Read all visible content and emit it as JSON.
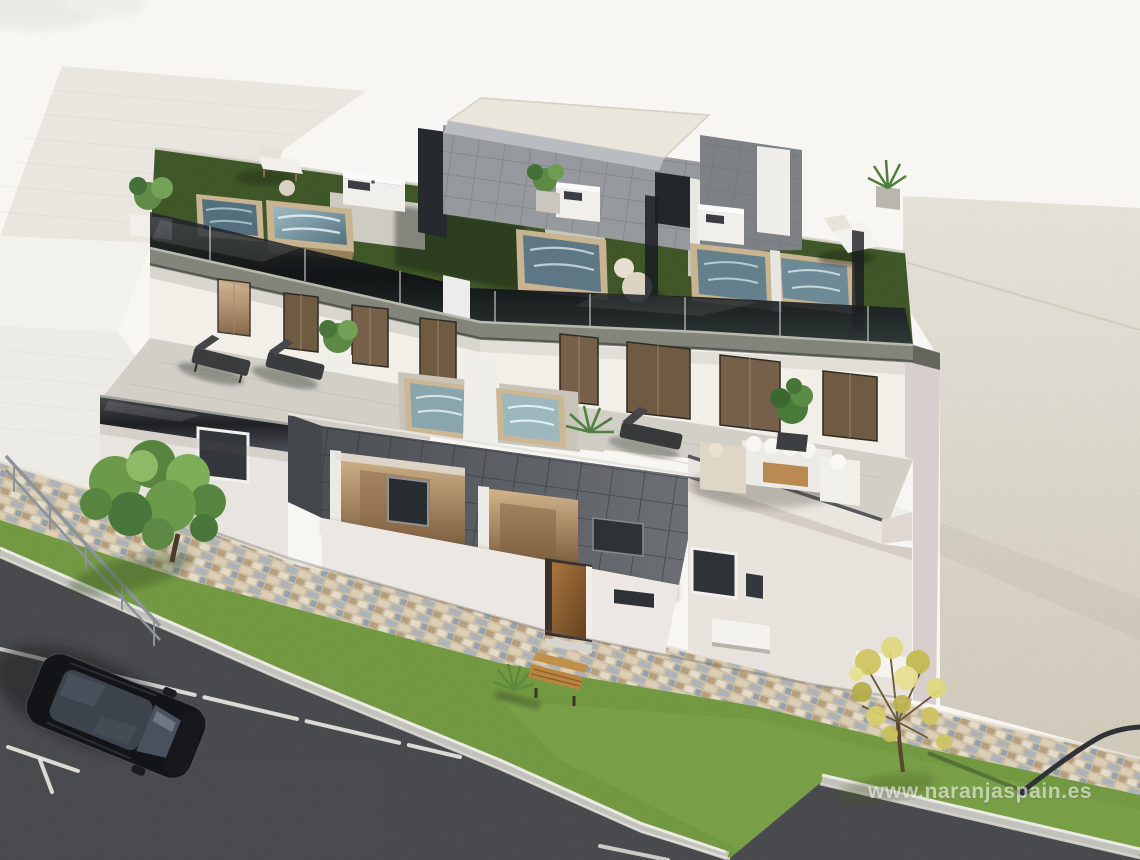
{
  "watermark": {
    "text": "www.naranjaspain.es",
    "color_hex": "#ffffff",
    "opacity": 0.58
  },
  "scene": {
    "kind": "architectural-render",
    "view": "aerial-oblique",
    "description": "New-build modern two-storey residential duplex with rooftop terraces, artificial grass, plunge pools, glass balustrades, anthracite tile cladding, street with parked black SUV, cobblestone sidewalk, lawns and trees, empty plot at right",
    "objects": [
      {
        "label": "neighbouring white building"
      },
      {
        "label": "main duplex building"
      },
      {
        "label": "rooftop terraces with artificial grass"
      },
      {
        "label": "rooftop plunge pools with wooden rims"
      },
      {
        "label": "rooftop outdoor kitchens"
      },
      {
        "label": "penthouse stair-access box"
      },
      {
        "label": "dark glass balustrades"
      },
      {
        "label": "first-floor terrace with plunge pools"
      },
      {
        "label": "outdoor sofa set and coffee table"
      },
      {
        "label": "sun loungers"
      },
      {
        "label": "round poufs"
      },
      {
        "label": "potted plants"
      },
      {
        "label": "bronze glazed terrace doors"
      },
      {
        "label": "anthracite tiled facade volume"
      },
      {
        "label": "wooden entrance door"
      },
      {
        "label": "cobblestone sidewalk"
      },
      {
        "label": "lawn strip"
      },
      {
        "label": "green tree"
      },
      {
        "label": "yellow autumn tree"
      },
      {
        "label": "wooden bench"
      },
      {
        "label": "metal handrail"
      },
      {
        "label": "street lamp"
      },
      {
        "label": "asphalt street with white road markings"
      },
      {
        "label": "parking bay lines"
      },
      {
        "label": "black SUV parked"
      },
      {
        "label": "empty gravel plot"
      }
    ]
  },
  "colors": {
    "sky": "#f7f6f3",
    "lot_far": "#ebe8df",
    "lot_near": "#dcd6c7",
    "neighbor_roof": "#e9e6e0",
    "neighbor_band": "#f3f1ec",
    "neighbor_wall": "#edebe5",
    "wall_white": "#f2efe9",
    "wall_shaded": "#e7e1dc",
    "wall_pink": "#d9cfce",
    "fascia": "#83857a",
    "fascia_dark": "#64665c",
    "glass_dark": "#14171c",
    "tile_dark": "#5d6166",
    "tile_side": "#43464b",
    "penthouse_tile": "#96999e",
    "roof_slab": "#eae6dc",
    "grass_roof": "#46602c",
    "grass_lawn": "#7aa246",
    "pool_water_dark": "#54707e",
    "pool_water_light": "#8fb0ba",
    "pool_rim": "#c9b492",
    "terrace_floor": "#d2cfc7",
    "cobble_base": "#cbbda2",
    "asphalt": "#45474a",
    "curb_concrete": "#c3c1bb",
    "road_marking": "#eceae4",
    "door_bronze": "#6f5a42",
    "door_wood": "#9a6b3f",
    "interior_warm": "#c7a87e",
    "bench_wood": "#b9853f",
    "tree_green": "#629147",
    "tree_yellow": "#cfc45e",
    "car_body": "#131417",
    "car_glass": "#3c434c",
    "metal": "#8d9499",
    "white_furniture": "#f0eee9"
  }
}
